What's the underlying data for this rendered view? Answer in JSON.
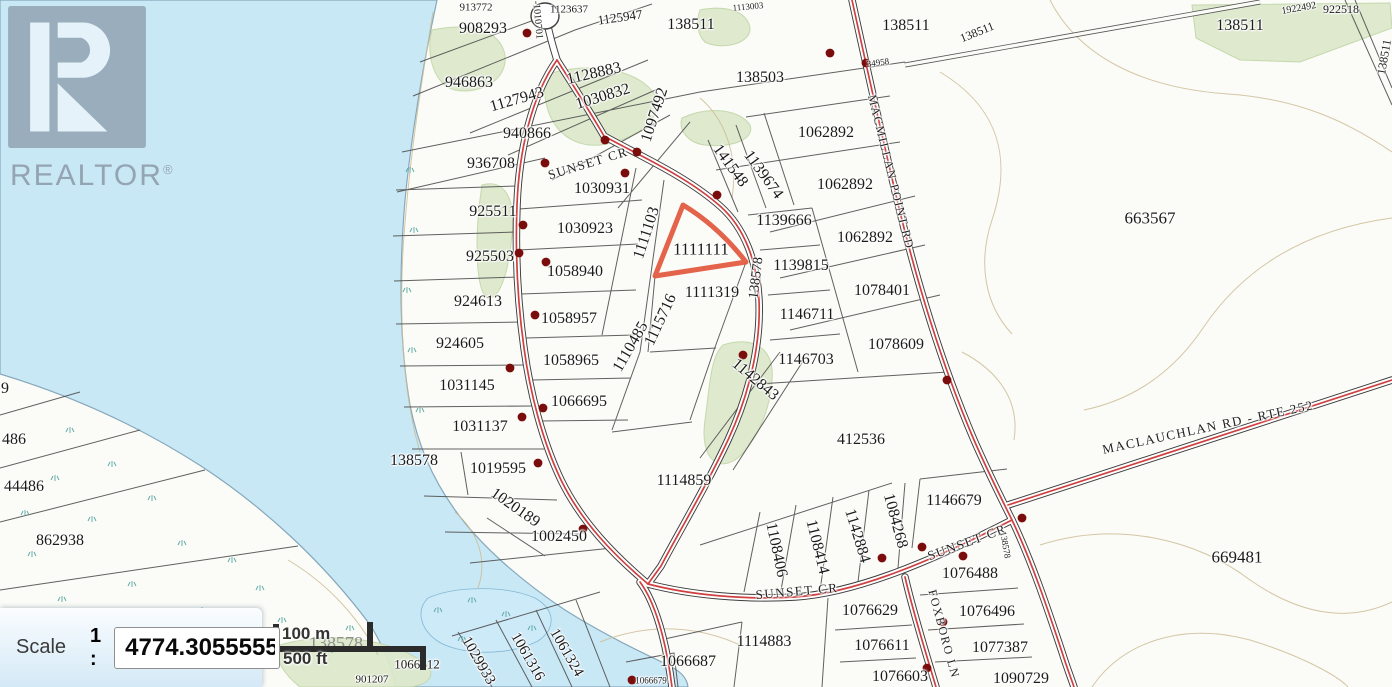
{
  "watermark": {
    "brand": "REALTOR",
    "reg": "®"
  },
  "scale_control": {
    "label": "Scale",
    "ratio_prefix": "1 :",
    "value": "4774.30555555"
  },
  "scale_bar": {
    "metric": "100 m",
    "imperial": "500 ft"
  },
  "colors": {
    "water": "#c9e8f6",
    "highlight": "#e2573d",
    "road_red": "#cf4040",
    "vegetation": "#dde9cc",
    "dot": "#7a0c0c"
  },
  "map": {
    "highlighted_parcel": "1111111",
    "labels": [
      {
        "t": "913772",
        "x": 476,
        "y": 8,
        "s": 11
      },
      {
        "t": "908293",
        "x": 483,
        "y": 29,
        "s": 16
      },
      {
        "t": "-1010701",
        "x": 537,
        "y": 20,
        "s": 10,
        "r": 85
      },
      {
        "t": "1123637",
        "x": 569,
        "y": 10,
        "s": 11
      },
      {
        "t": "1125947",
        "x": 620,
        "y": 17,
        "s": 13,
        "r": -8
      },
      {
        "t": "138511",
        "x": 691,
        "y": 25,
        "s": 16
      },
      {
        "t": "1113003",
        "x": 748,
        "y": 7,
        "s": 9,
        "r": -5
      },
      {
        "t": "138511",
        "x": 906,
        "y": 26,
        "s": 16
      },
      {
        "t": "34958",
        "x": 878,
        "y": 63,
        "s": 9,
        "r": -8
      },
      {
        "t": "138511",
        "x": 977,
        "y": 32,
        "s": 12,
        "r": -22
      },
      {
        "t": "1922492",
        "x": 1299,
        "y": 9,
        "s": 10,
        "r": -10
      },
      {
        "t": "922518",
        "x": 1341,
        "y": 9,
        "s": 12
      },
      {
        "t": "138511",
        "x": 1240,
        "y": 26,
        "s": 16
      },
      {
        "t": "138511",
        "x": 1384,
        "y": 57,
        "s": 12,
        "r": -80
      },
      {
        "t": "946863",
        "x": 469,
        "y": 83,
        "s": 16
      },
      {
        "t": "1127943",
        "x": 517,
        "y": 100,
        "s": 16,
        "r": -16
      },
      {
        "t": "1128883",
        "x": 594,
        "y": 74,
        "s": 16,
        "r": -13
      },
      {
        "t": "1030832",
        "x": 603,
        "y": 97,
        "s": 16,
        "r": -17
      },
      {
        "t": "1097492",
        "x": 655,
        "y": 115,
        "s": 16,
        "r": -72
      },
      {
        "t": "138503",
        "x": 760,
        "y": 78,
        "s": 16
      },
      {
        "t": "940866",
        "x": 527,
        "y": 134,
        "s": 16
      },
      {
        "t": "936708",
        "x": 491,
        "y": 164,
        "s": 16
      },
      {
        "t": "SUNSET CR",
        "x": 588,
        "y": 163,
        "s": 13,
        "r": -17,
        "c": "rd"
      },
      {
        "t": "1030931",
        "x": 602,
        "y": 189,
        "s": 16
      },
      {
        "t": "925511",
        "x": 493,
        "y": 212,
        "s": 16
      },
      {
        "t": "1030923",
        "x": 585,
        "y": 229,
        "s": 16
      },
      {
        "t": "1111103",
        "x": 647,
        "y": 233,
        "s": 16,
        "r": -72
      },
      {
        "t": "141548",
        "x": 730,
        "y": 166,
        "s": 16,
        "r": 54
      },
      {
        "t": "1139674",
        "x": 763,
        "y": 175,
        "s": 16,
        "r": 54
      },
      {
        "t": "MACMILLAN POINT RD",
        "x": 891,
        "y": 172,
        "s": 12,
        "r": 76,
        "c": "rd"
      },
      {
        "t": "1062892",
        "x": 826,
        "y": 133,
        "s": 16
      },
      {
        "t": "1062892",
        "x": 845,
        "y": 185,
        "s": 16
      },
      {
        "t": "1139666",
        "x": 784,
        "y": 221,
        "s": 16
      },
      {
        "t": "1062892",
        "x": 865,
        "y": 238,
        "s": 16
      },
      {
        "t": "925503",
        "x": 490,
        "y": 257,
        "s": 16
      },
      {
        "t": "1058940",
        "x": 575,
        "y": 272,
        "s": 16
      },
      {
        "t": "1111111",
        "x": 701,
        "y": 249,
        "s": 17
      },
      {
        "t": "1139815",
        "x": 801,
        "y": 266,
        "s": 16
      },
      {
        "t": "138578",
        "x": 757,
        "y": 278,
        "s": 14,
        "r": -83
      },
      {
        "t": "1078401",
        "x": 882,
        "y": 291,
        "s": 16
      },
      {
        "t": "924613",
        "x": 478,
        "y": 302,
        "s": 16
      },
      {
        "t": "1058957",
        "x": 569,
        "y": 319,
        "s": 16
      },
      {
        "t": "1146711",
        "x": 807,
        "y": 315,
        "s": 16
      },
      {
        "t": "1115716",
        "x": 661,
        "y": 320,
        "s": 16,
        "r": -65
      },
      {
        "t": "1110485",
        "x": 631,
        "y": 347,
        "s": 16,
        "r": -60
      },
      {
        "t": "1111319",
        "x": 712,
        "y": 293,
        "s": 16
      },
      {
        "t": "924605",
        "x": 460,
        "y": 344,
        "s": 16
      },
      {
        "t": "1058965",
        "x": 571,
        "y": 361,
        "s": 16
      },
      {
        "t": "1146703",
        "x": 806,
        "y": 360,
        "s": 16
      },
      {
        "t": "1078609",
        "x": 896,
        "y": 345,
        "s": 16
      },
      {
        "t": "1031145",
        "x": 467,
        "y": 386,
        "s": 16
      },
      {
        "t": "1066695",
        "x": 579,
        "y": 402,
        "s": 16
      },
      {
        "t": "1142843",
        "x": 755,
        "y": 380,
        "s": 16,
        "r": 40
      },
      {
        "t": "663567",
        "x": 1150,
        "y": 218,
        "s": 17
      },
      {
        "t": "1031137",
        "x": 480,
        "y": 427,
        "s": 16
      },
      {
        "t": "412536",
        "x": 861,
        "y": 440,
        "s": 16
      },
      {
        "t": "138578",
        "x": 414,
        "y": 461,
        "s": 16
      },
      {
        "t": "1019595",
        "x": 498,
        "y": 469,
        "s": 16
      },
      {
        "t": "1114859",
        "x": 684,
        "y": 481,
        "s": 16
      },
      {
        "t": "1020189",
        "x": 515,
        "y": 508,
        "s": 16,
        "r": 35
      },
      {
        "t": "1002450",
        "x": 559,
        "y": 537,
        "s": 16
      },
      {
        "t": "1108406",
        "x": 776,
        "y": 550,
        "s": 16,
        "r": 78
      },
      {
        "t": "1108414",
        "x": 817,
        "y": 547,
        "s": 16,
        "r": 76
      },
      {
        "t": "1142884",
        "x": 857,
        "y": 536,
        "s": 16,
        "r": 73
      },
      {
        "t": "1084268",
        "x": 895,
        "y": 521,
        "s": 16,
        "r": 75
      },
      {
        "t": "1146679",
        "x": 954,
        "y": 501,
        "s": 16
      },
      {
        "t": "SUNSET CR",
        "x": 967,
        "y": 542,
        "s": 13,
        "r": -20,
        "c": "rd"
      },
      {
        "t": "MACLAUCHLAN RD - RTE 252",
        "x": 1208,
        "y": 427,
        "s": 13,
        "r": -12,
        "c": "rd"
      },
      {
        "t": "138578",
        "x": 1005,
        "y": 545,
        "s": 9,
        "r": 80
      },
      {
        "t": "669481",
        "x": 1237,
        "y": 557,
        "s": 17
      },
      {
        "t": "SUNSET CR",
        "x": 797,
        "y": 591,
        "s": 13,
        "r": -5,
        "c": "rd"
      },
      {
        "t": "FOXBORO LN",
        "x": 944,
        "y": 634,
        "s": 12,
        "r": 75,
        "c": "rd"
      },
      {
        "t": "1076488",
        "x": 970,
        "y": 574,
        "s": 16
      },
      {
        "t": "1076629",
        "x": 870,
        "y": 611,
        "s": 16
      },
      {
        "t": "1076496",
        "x": 987,
        "y": 612,
        "s": 16
      },
      {
        "t": "1076611",
        "x": 882,
        "y": 646,
        "s": 16
      },
      {
        "t": "1077387",
        "x": 1000,
        "y": 648,
        "s": 16
      },
      {
        "t": "1076603",
        "x": 900,
        "y": 677,
        "s": 16
      },
      {
        "t": "1090729",
        "x": 1021,
        "y": 679,
        "s": 16
      },
      {
        "t": "9",
        "x": 5,
        "y": 389,
        "s": 16
      },
      {
        "t": "486",
        "x": 14,
        "y": 440,
        "s": 16
      },
      {
        "t": "44486",
        "x": 24,
        "y": 487,
        "s": 16
      },
      {
        "t": "862938",
        "x": 60,
        "y": 541,
        "s": 16
      },
      {
        "t": "138578",
        "x": 336,
        "y": 643,
        "s": 18,
        "c": "gy"
      },
      {
        "t": "1066612",
        "x": 417,
        "y": 664,
        "s": 13
      },
      {
        "t": "901207",
        "x": 372,
        "y": 680,
        "s": 11
      },
      {
        "t": "1029933",
        "x": 478,
        "y": 661,
        "s": 15,
        "r": 60
      },
      {
        "t": "1061316",
        "x": 527,
        "y": 657,
        "s": 15,
        "r": 60
      },
      {
        "t": "1061324",
        "x": 566,
        "y": 653,
        "s": 15,
        "r": 60
      },
      {
        "t": "1114883",
        "x": 764,
        "y": 642,
        "s": 16
      },
      {
        "t": "1066687",
        "x": 688,
        "y": 662,
        "s": 16
      },
      {
        "t": "1066679",
        "x": 651,
        "y": 681,
        "s": 9
      }
    ],
    "address_points": [
      [
        527,
        33
      ],
      [
        605,
        140
      ],
      [
        637,
        152
      ],
      [
        625,
        173
      ],
      [
        545,
        163
      ],
      [
        523,
        225
      ],
      [
        519,
        253
      ],
      [
        546,
        262
      ],
      [
        717,
        195
      ],
      [
        830,
        53
      ],
      [
        866,
        63
      ],
      [
        535,
        315
      ],
      [
        510,
        368
      ],
      [
        543,
        408
      ],
      [
        522,
        417
      ],
      [
        538,
        463
      ],
      [
        583,
        529
      ],
      [
        743,
        355
      ],
      [
        947,
        380
      ],
      [
        882,
        558
      ],
      [
        922,
        547
      ],
      [
        963,
        556
      ],
      [
        943,
        622
      ],
      [
        927,
        668
      ],
      [
        1022,
        518
      ],
      [
        632,
        680
      ]
    ]
  }
}
